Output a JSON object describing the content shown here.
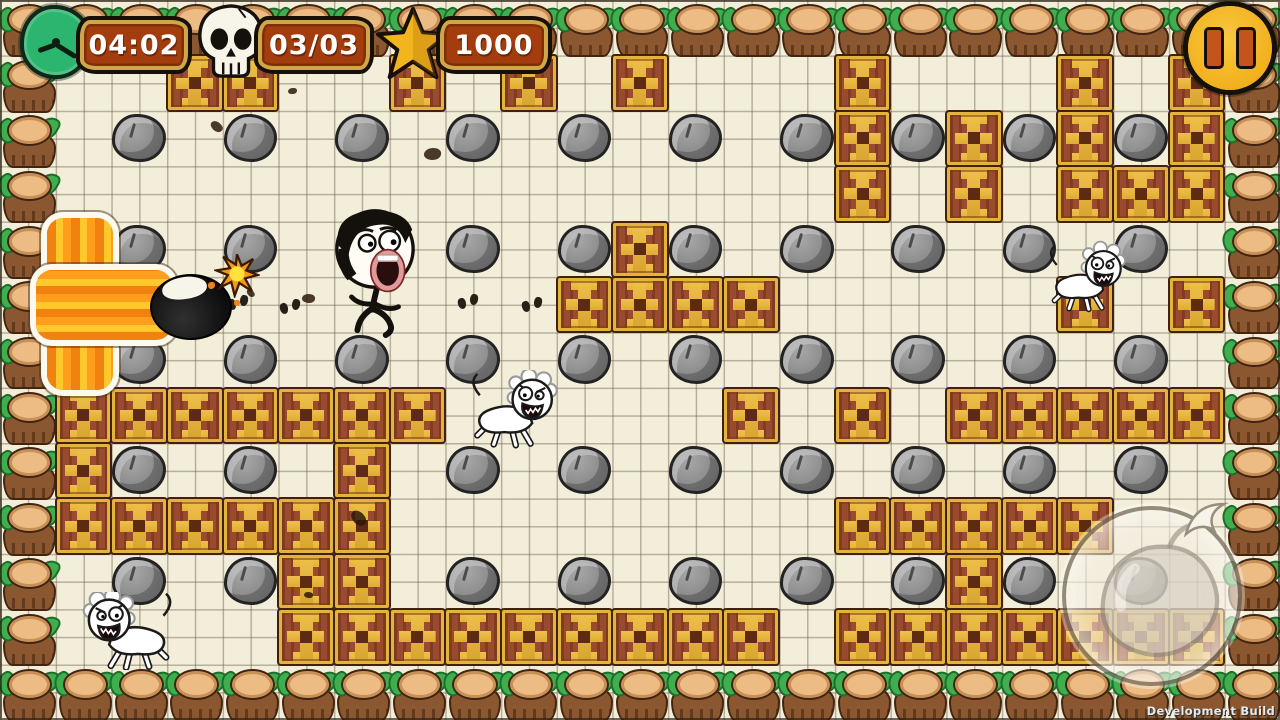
{
  "hud": {
    "timer": {
      "icon": "clock-icon",
      "value": "04:02"
    },
    "kills": {
      "icon": "skull-icon",
      "value": "03/03"
    },
    "score": {
      "icon": "star-icon",
      "value": "1000"
    },
    "pause_icon": "pause-icon"
  },
  "build_label": "Development Build",
  "field": {
    "cols": 23,
    "rows": 13,
    "border": "tree-stumps",
    "bricks": [
      [
        3,
        1
      ],
      [
        4,
        1
      ],
      [
        7,
        1
      ],
      [
        9,
        1
      ],
      [
        11,
        1
      ],
      [
        15,
        1
      ],
      [
        19,
        1
      ],
      [
        21,
        1
      ],
      [
        15,
        2
      ],
      [
        17,
        2
      ],
      [
        19,
        2
      ],
      [
        21,
        2
      ],
      [
        15,
        3
      ],
      [
        17,
        3
      ],
      [
        19,
        3
      ],
      [
        20,
        3
      ],
      [
        21,
        3
      ],
      [
        11,
        4
      ],
      [
        10,
        5
      ],
      [
        11,
        5
      ],
      [
        12,
        5
      ],
      [
        13,
        5
      ],
      [
        19,
        5
      ],
      [
        21,
        5
      ],
      [
        1,
        7
      ],
      [
        2,
        7
      ],
      [
        3,
        7
      ],
      [
        4,
        7
      ],
      [
        5,
        7
      ],
      [
        6,
        7
      ],
      [
        7,
        7
      ],
      [
        13,
        7
      ],
      [
        15,
        7
      ],
      [
        17,
        7
      ],
      [
        18,
        7
      ],
      [
        19,
        7
      ],
      [
        20,
        7
      ],
      [
        21,
        7
      ],
      [
        1,
        8
      ],
      [
        6,
        8
      ],
      [
        1,
        9
      ],
      [
        2,
        9
      ],
      [
        3,
        9
      ],
      [
        4,
        9
      ],
      [
        5,
        9
      ],
      [
        6,
        9
      ],
      [
        15,
        9
      ],
      [
        16,
        9
      ],
      [
        17,
        9
      ],
      [
        18,
        9
      ],
      [
        19,
        9
      ],
      [
        5,
        10
      ],
      [
        6,
        10
      ],
      [
        17,
        10
      ],
      [
        5,
        11
      ],
      [
        6,
        11
      ],
      [
        7,
        11
      ],
      [
        8,
        11
      ],
      [
        9,
        11
      ],
      [
        10,
        11
      ],
      [
        11,
        11
      ],
      [
        12,
        11
      ],
      [
        13,
        11
      ],
      [
        15,
        11
      ],
      [
        16,
        11
      ],
      [
        17,
        11
      ],
      [
        18,
        11
      ],
      [
        19,
        11
      ],
      [
        20,
        11
      ],
      [
        21,
        11
      ]
    ],
    "rocks": [
      [
        2,
        2
      ],
      [
        4,
        2
      ],
      [
        6,
        2
      ],
      [
        8,
        2
      ],
      [
        10,
        2
      ],
      [
        12,
        2
      ],
      [
        14,
        2
      ],
      [
        16,
        2
      ],
      [
        18,
        2
      ],
      [
        20,
        2
      ],
      [
        2,
        4
      ],
      [
        4,
        4
      ],
      [
        8,
        4
      ],
      [
        10,
        4
      ],
      [
        12,
        4
      ],
      [
        14,
        4
      ],
      [
        16,
        4
      ],
      [
        18,
        4
      ],
      [
        20,
        4
      ],
      [
        2,
        6
      ],
      [
        4,
        6
      ],
      [
        6,
        6
      ],
      [
        8,
        6
      ],
      [
        10,
        6
      ],
      [
        12,
        6
      ],
      [
        14,
        6
      ],
      [
        16,
        6
      ],
      [
        18,
        6
      ],
      [
        20,
        6
      ],
      [
        2,
        8
      ],
      [
        4,
        8
      ],
      [
        8,
        8
      ],
      [
        10,
        8
      ],
      [
        12,
        8
      ],
      [
        14,
        8
      ],
      [
        16,
        8
      ],
      [
        18,
        8
      ],
      [
        20,
        8
      ],
      [
        2,
        10
      ],
      [
        4,
        10
      ],
      [
        8,
        10
      ],
      [
        10,
        10
      ],
      [
        12,
        10
      ],
      [
        14,
        10
      ],
      [
        16,
        10
      ],
      [
        18,
        10
      ],
      [
        20,
        10
      ]
    ]
  },
  "entities": {
    "player": {
      "x": 325,
      "y": 206,
      "w": 100,
      "h": 132
    },
    "enemies": [
      {
        "x": 1048,
        "y": 240,
        "w": 80,
        "h": 76,
        "flip": true
      },
      {
        "x": 470,
        "y": 370,
        "w": 90,
        "h": 80,
        "flip": true
      },
      {
        "x": 80,
        "y": 592,
        "w": 94,
        "h": 78,
        "flip": false
      }
    ],
    "bomb": {
      "x": 150,
      "y": 274,
      "w": 78,
      "h": 62
    },
    "explosion": {
      "v": {
        "x": 47,
        "y": 218,
        "w": 66,
        "h": 172
      },
      "h": {
        "x": 36,
        "y": 270,
        "w": 136,
        "h": 70
      }
    },
    "footprints": [
      [
        228,
        295
      ],
      [
        280,
        299
      ],
      [
        458,
        294
      ],
      [
        522,
        297
      ]
    ],
    "splotches": [
      [
        288,
        88
      ],
      [
        210,
        122
      ],
      [
        424,
        148
      ],
      [
        246,
        290
      ],
      [
        302,
        294
      ],
      [
        350,
        512
      ],
      [
        304,
        592
      ]
    ]
  },
  "controls": {
    "bomb_button": {
      "x": 1062,
      "y": 506,
      "size": 172
    }
  },
  "colors": {
    "background": "#f3eed9",
    "brick_red": "#9a4a2e",
    "brick_gold": "#e3b33c",
    "rock_gray": "#8d8d8d",
    "stump_brown": "#8a5730",
    "leaf_green": "#3fae4e",
    "banner_red": "#a33d0d",
    "banner_gold": "#cfa64a",
    "hud_yellow": "#f2b01e",
    "clock_green": "#2cb56f",
    "explosion_orange": "#f2820f"
  }
}
